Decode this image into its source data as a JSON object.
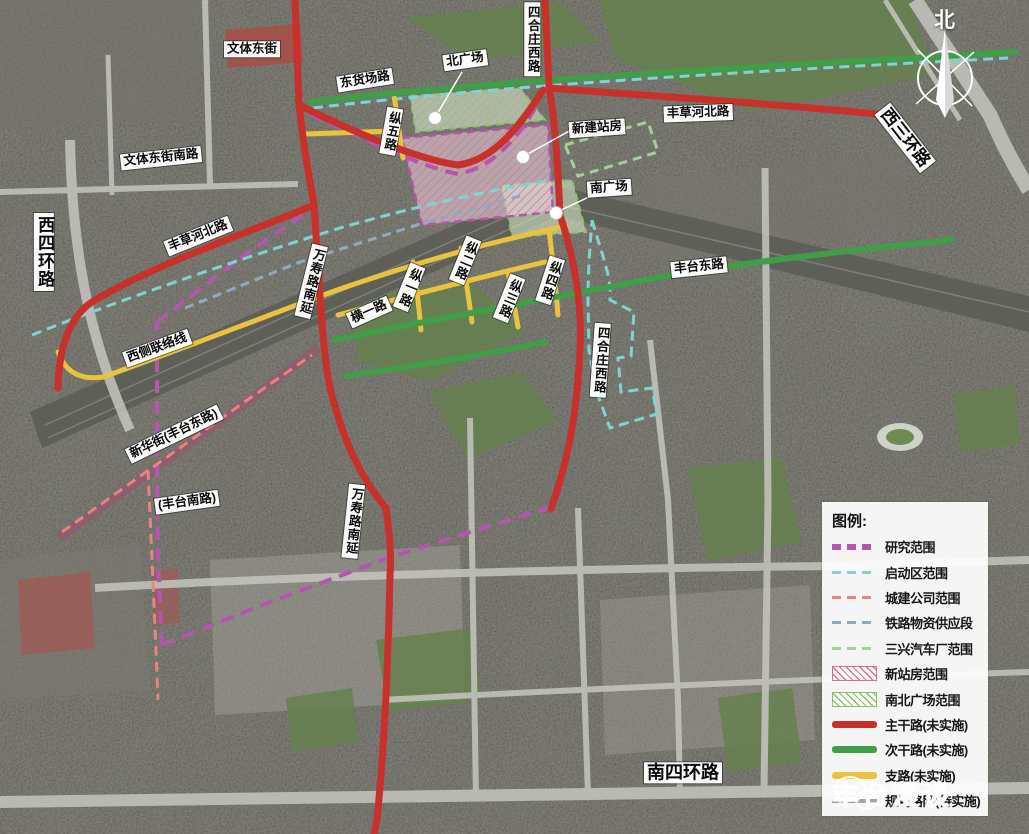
{
  "colors": {
    "red": "#c8312b",
    "green": "#3f9e47",
    "yellow": "#e9c33f",
    "grayroad": "#9c9c98",
    "magenta": "#b455ae",
    "cyan": "#7fd4d2",
    "pink": "#e8837f",
    "blue": "#8fa9c2",
    "lightgreen": "#a5cf9b",
    "hatchpink": "#d9728f",
    "hatchgreen": "#8fbf6e"
  },
  "map": {
    "compass_north": "北",
    "labels": [
      {
        "text": "文体东街",
        "x": 252,
        "y": 49,
        "rot": 0
      },
      {
        "text": "文体东街南路",
        "x": 161,
        "y": 158,
        "rot": -6
      },
      {
        "text": "东货场路",
        "x": 365,
        "y": 80,
        "rot": -9
      },
      {
        "text": "北广场",
        "x": 465,
        "y": 60,
        "rot": -8
      },
      {
        "text": "四合庄西路",
        "x": 532,
        "y": 39,
        "rot": 0,
        "v": true
      },
      {
        "text": "新建站房",
        "x": 597,
        "y": 128,
        "rot": -4
      },
      {
        "text": "南广场",
        "x": 609,
        "y": 188,
        "rot": -4
      },
      {
        "text": "丰草河北路",
        "x": 698,
        "y": 113,
        "rot": -2
      },
      {
        "text": "西三环路",
        "x": 905,
        "y": 138,
        "rot": 52,
        "size": 17
      },
      {
        "text": "西四环路",
        "x": 44,
        "y": 252,
        "rot": 0,
        "v": true,
        "size": 17
      },
      {
        "text": "丰草河北路",
        "x": 198,
        "y": 236,
        "rot": -22
      },
      {
        "text": "万寿路南延",
        "x": 311,
        "y": 281,
        "rot": 14,
        "v": true
      },
      {
        "text": "纵五路",
        "x": 391,
        "y": 131,
        "rot": 10,
        "v": true
      },
      {
        "text": "横一路",
        "x": 369,
        "y": 312,
        "rot": -24
      },
      {
        "text": "纵一路",
        "x": 409,
        "y": 287,
        "rot": 22,
        "v": true
      },
      {
        "text": "纵二路",
        "x": 465,
        "y": 260,
        "rot": 22,
        "v": true
      },
      {
        "text": "纵三路",
        "x": 509,
        "y": 298,
        "rot": 22,
        "v": true
      },
      {
        "text": "纵四路",
        "x": 550,
        "y": 280,
        "rot": 18,
        "v": true
      },
      {
        "text": "丰台东路",
        "x": 699,
        "y": 267,
        "rot": -6
      },
      {
        "text": "四合庄西路",
        "x": 600,
        "y": 360,
        "rot": 4,
        "v": true
      },
      {
        "text": "西侧联络线",
        "x": 157,
        "y": 348,
        "rot": -20
      },
      {
        "text": "新华街(丰台东路)",
        "x": 174,
        "y": 434,
        "rot": -26
      },
      {
        "text": "(丰台南路)",
        "x": 187,
        "y": 502,
        "rot": -8
      },
      {
        "text": "万寿路南延",
        "x": 353,
        "y": 521,
        "rot": 6,
        "v": true
      },
      {
        "text": "南四环路",
        "x": 683,
        "y": 773,
        "rot": 0,
        "size": 18
      }
    ]
  },
  "legend": {
    "title": "图例:",
    "items": [
      {
        "label": "研究范围",
        "swatch": "dash-thick",
        "color": "#b455ae"
      },
      {
        "label": "启动区范围",
        "swatch": "dash",
        "color": "#86d2cf"
      },
      {
        "label": "城建公司范围",
        "swatch": "dash",
        "color": "#e8837f"
      },
      {
        "label": "铁路物资供应段",
        "swatch": "dash",
        "color": "#8fa9c2"
      },
      {
        "label": "三兴汽车厂范围",
        "swatch": "dash",
        "color": "#a5cf9b"
      },
      {
        "label": "新站房范围",
        "swatch": "hatch",
        "color": "#d9728f"
      },
      {
        "label": "南北广场范围",
        "swatch": "hatch",
        "color": "#8fbf6e"
      },
      {
        "label": "主干路(未实施)",
        "swatch": "solid-thick",
        "color": "#c8312b"
      },
      {
        "label": "次干路(未实施)",
        "swatch": "solid-thick",
        "color": "#3f9e47"
      },
      {
        "label": "支路(未实施)",
        "swatch": "solid-thick",
        "color": "#e9c33f"
      },
      {
        "label": "规划路网(待实施)",
        "swatch": "solid",
        "color": "#9c9c98"
      }
    ]
  },
  "watermark": {
    "text": "丰台漫谈"
  }
}
